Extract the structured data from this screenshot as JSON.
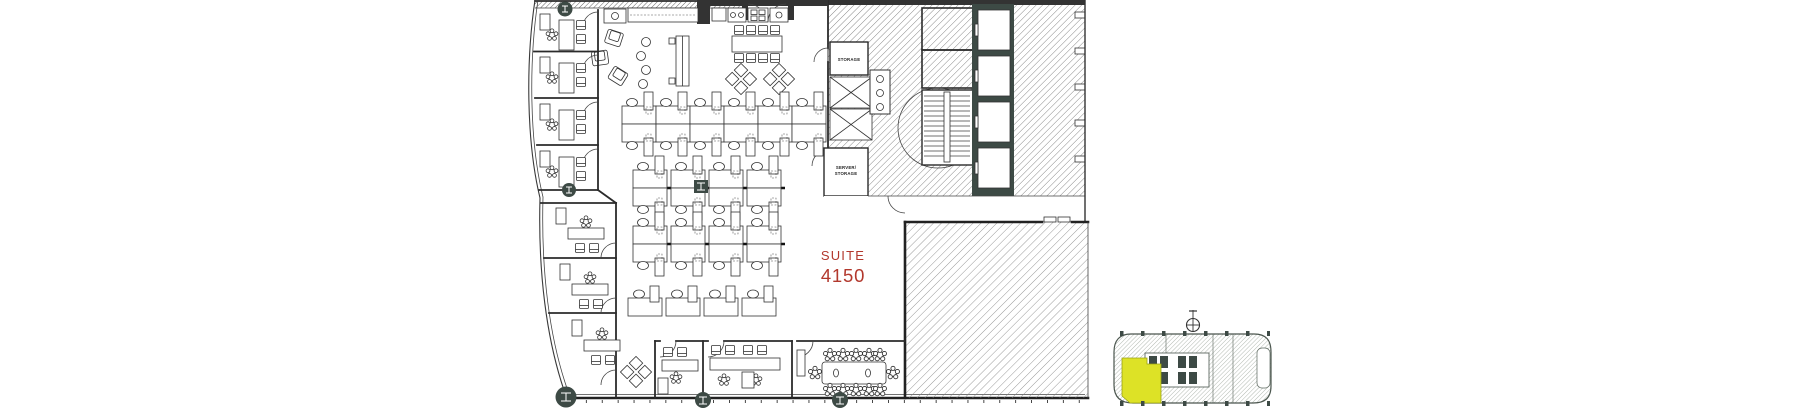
{
  "floor_plan": {
    "suite": {
      "name": "SUITE",
      "number": "4150"
    },
    "core_rooms": {
      "storage": "STORAGE",
      "server_line1": "SERVER/",
      "server_line2": "STORAGE"
    }
  },
  "colors": {
    "suite_text": "#b2382d",
    "keyplan_highlight": "#dde226",
    "column_dark": "#3d4a45",
    "hatch_line": "#777777"
  },
  "icons": {
    "north_arrow": "crosshair-circle north indicator",
    "task_chair": "flower-style task chair symbol",
    "column": "round steel column with I-beam glyph",
    "stair": "stair treads",
    "elevator": "elevator cab"
  }
}
